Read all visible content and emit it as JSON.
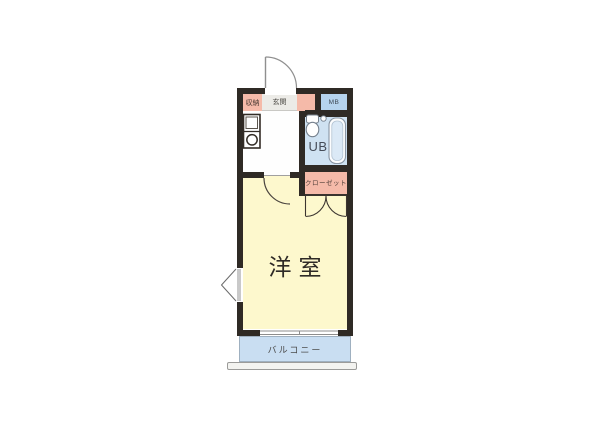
{
  "title": "apartment-floor-plan",
  "labels": {
    "storage": "収納",
    "entrance": "玄関",
    "meter_box": "MB",
    "unit_bath": "UB",
    "closet": "クローゼット",
    "western_room": "洋室",
    "balcony": "バルコニー"
  },
  "colors": {
    "wall": "#2f2a25",
    "storage_pink": "#f5baa9",
    "closet_pink": "#f5baa9",
    "entrance_gray": "#ecebe7",
    "meter_box_blue": "#b6d3ee",
    "unit_bath_blue": "#cfe2f2",
    "western_room_yellow": "#fdf8cd",
    "balcony_blue": "#c9def2",
    "railing_gray": "#f3f3f0",
    "background": "#ffffff"
  }
}
